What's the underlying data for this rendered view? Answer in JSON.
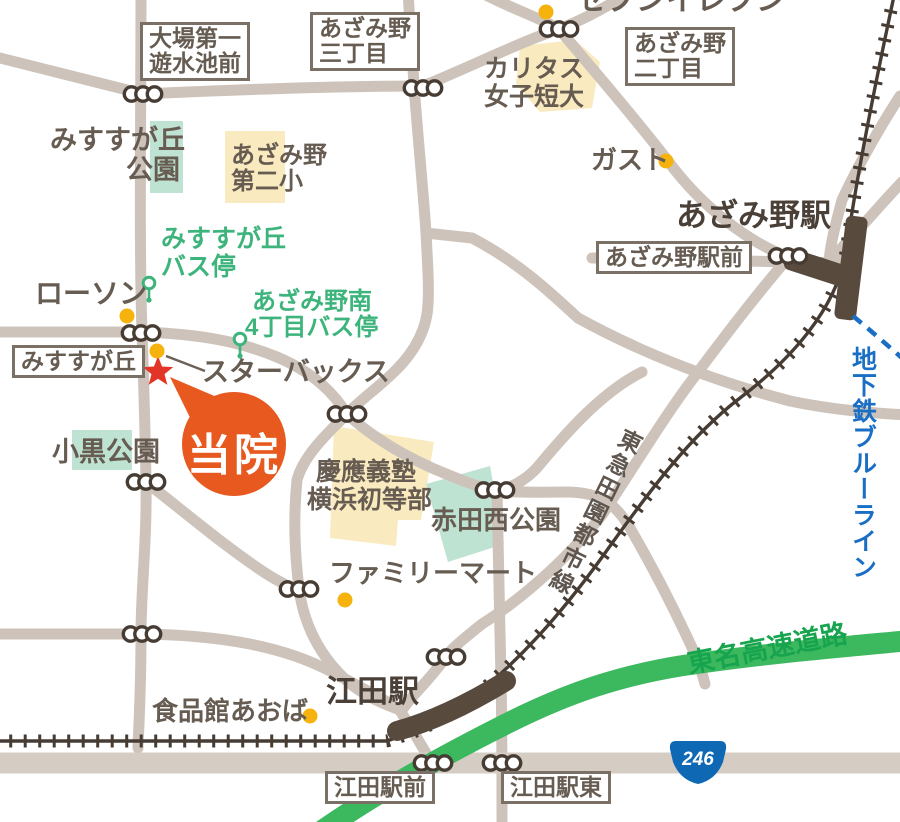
{
  "map": {
    "title": "当院アクセスマップ（あざみ野・江田周辺）",
    "colors": {
      "road": "#cdc3ba",
      "road_246": "#d5ccc4",
      "railway": "#463c33",
      "station_marker": "#594a3e",
      "highway_green": "#3cb85f",
      "area_yellow": "#faeabf",
      "area_teal": "#bfe3d2",
      "label_text": "#665c52",
      "bus_green": "#3db47b",
      "subway_blue": "#1a6fc4",
      "dot_yellow": "#f6b20d",
      "star_red": "#e23427",
      "balloon_orange": "#e7591e",
      "route_shield_blue": "#0e68b4"
    },
    "labels": {
      "boxed": {
        "oba": {
          "l1": "大場第一",
          "l2": "遊水池前"
        },
        "azamino3": {
          "l1": "あざみ野",
          "l2": "三丁目"
        },
        "azamino2": {
          "l1": "あざみ野",
          "l2": "二丁目"
        },
        "azamino_sta_front": "あざみ野駅前",
        "misusuga": "みすすが丘",
        "eda_front": "江田駅前",
        "eda_east": "江田駅東"
      },
      "stations": {
        "azamino": "あざみ野駅",
        "eda": "江田駅"
      },
      "pois": {
        "seven_eleven": "セブンイレブン",
        "caritas_l1": "カリタス",
        "caritas_l2": "女子短大",
        "gust": "ガスト",
        "lawson": "ローソン",
        "starbucks": "スターバックス",
        "familymart": "ファミリーマート",
        "shokuhinkan": "食品館あおば"
      },
      "parks": {
        "misusuga_l1": "みすすが丘",
        "misusuga_l2": "公園",
        "oguro": "小黒公園",
        "akada": "赤田西公園"
      },
      "schools": {
        "dai2_l1": "あざみ野",
        "dai2_l2": "第二小",
        "keio_l1": "慶應義塾",
        "keio_l2": "横浜初等部"
      },
      "bus_stops": {
        "misusuga_l1": "みすすが丘",
        "misusuga_l2": "バス停",
        "minami_l1": "あざみ野南",
        "minami_l2": "4丁目バス停"
      },
      "lines": {
        "denentoshi": "東急田園都市線",
        "blueline": "地下鉄ブルーライン",
        "tomei": "東名高速道路",
        "route_number": "246"
      },
      "clinic": "当院"
    }
  }
}
